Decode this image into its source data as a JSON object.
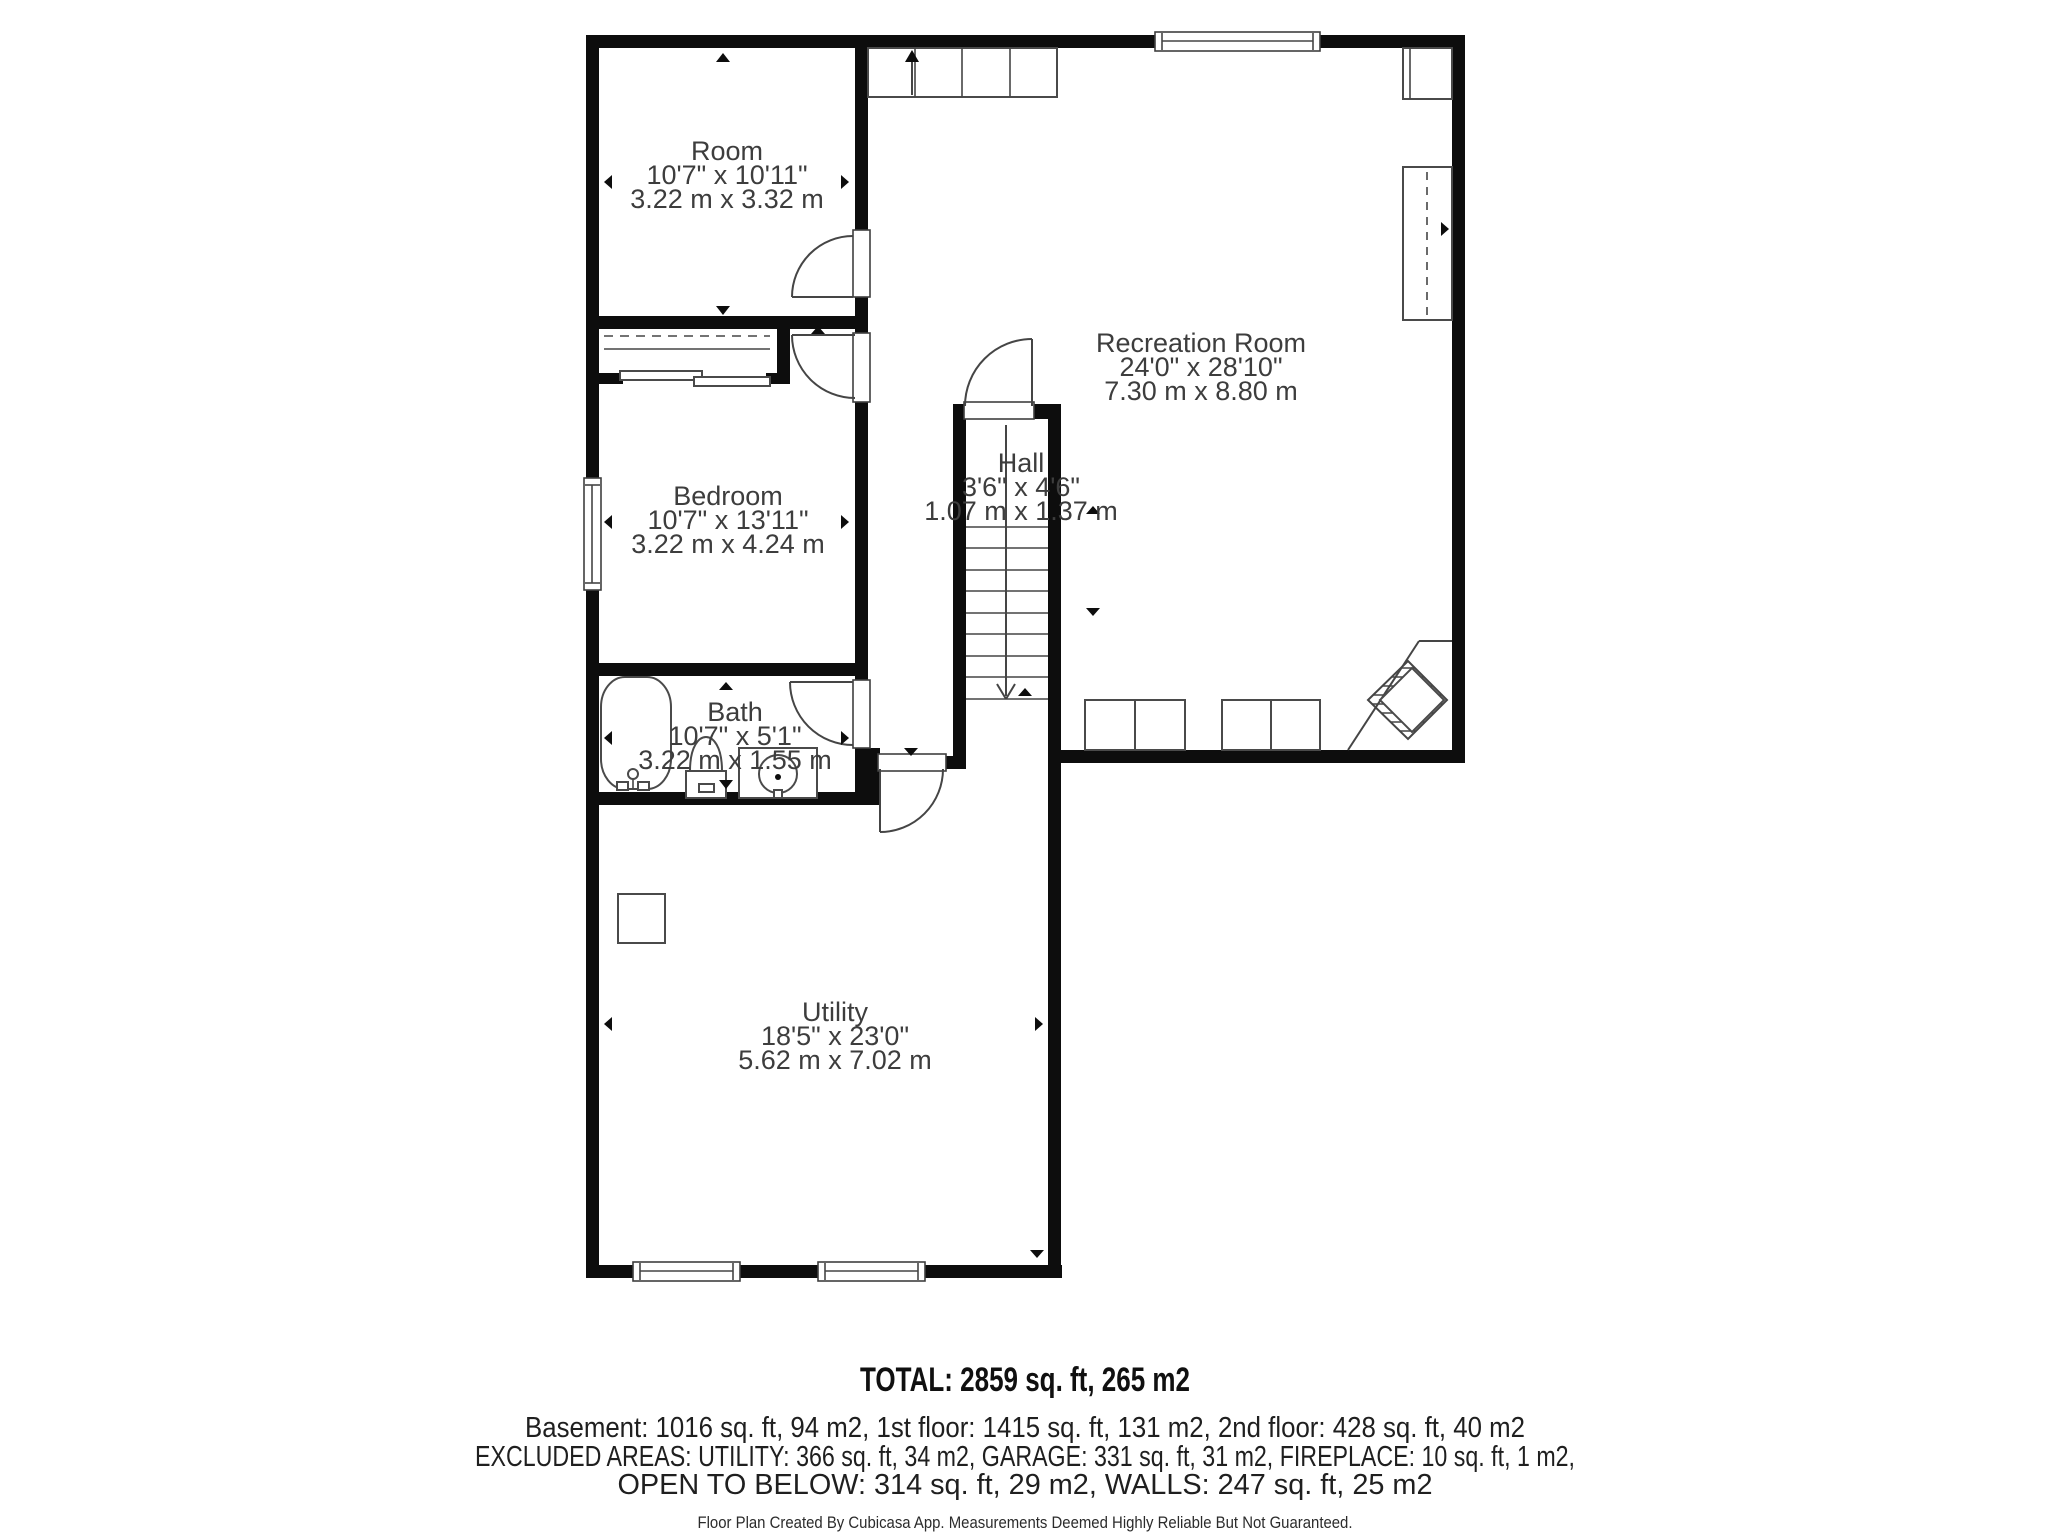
{
  "colors": {
    "wall": "#0d0d0d",
    "thin_line": "#454545",
    "room_label": "#3d3d3d",
    "footer_text": "#1f1f1f"
  },
  "rooms": {
    "room": {
      "name": "Room",
      "imperial": "10'7\" x 10'11\"",
      "metric": "3.22 m x 3.32 m"
    },
    "recreation": {
      "name": "Recreation Room",
      "imperial": "24'0\" x 28'10\"",
      "metric": "7.30 m x 8.80 m"
    },
    "hall": {
      "name": "Hall",
      "imperial": "3'6\" x 4'6\"",
      "metric": "1.07 m x 1.37 m"
    },
    "bedroom": {
      "name": "Bedroom",
      "imperial": "10'7\" x 13'11\"",
      "metric": "3.22 m x 4.24 m"
    },
    "bath": {
      "name": "Bath",
      "imperial": "10'7\" x 5'1\"",
      "metric": "3.22 m x 1.55 m"
    },
    "utility": {
      "name": "Utility",
      "imperial": "18'5\" x 23'0\"",
      "metric": "5.62 m x 7.02 m"
    }
  },
  "footer": {
    "total": "TOTAL: 2859 sq. ft, 265 m2",
    "floors": "Basement: 1016 sq. ft, 94 m2, 1st floor: 1415 sq. ft, 131 m2, 2nd floor: 428 sq. ft, 40 m2",
    "excluded_line1": "EXCLUDED AREAS: UTILITY: 366 sq. ft, 34 m2, GARAGE: 331 sq. ft, 31 m2, FIREPLACE: 10 sq. ft, 1 m2,",
    "excluded_line2": "OPEN TO BELOW: 314 sq. ft, 29 m2, WALLS: 247 sq. ft, 25 m2",
    "disclaimer": "Floor Plan Created By Cubicasa App. Measurements Deemed Highly Reliable But Not Guaranteed."
  }
}
